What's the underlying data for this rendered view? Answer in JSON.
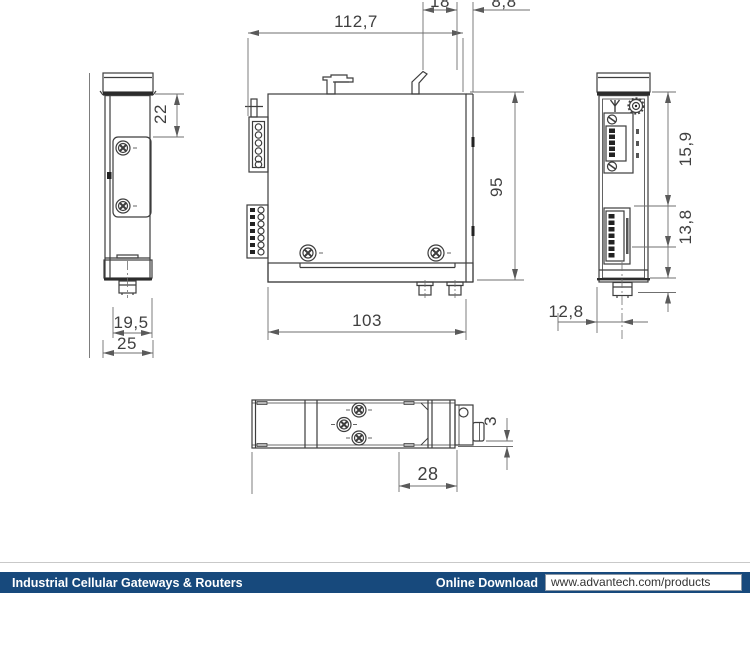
{
  "drawing": {
    "dims": {
      "top_overall_width": "112,7",
      "top_small_left": "18",
      "top_small_right": "8,8",
      "left_top_offset": "22",
      "left_inner_width": "19,5",
      "left_outer_width": "25",
      "front_height": "95",
      "front_width": "103",
      "right_block_top": "15,9",
      "right_block_bottom": "13,8",
      "right_foot_offset": "12,8",
      "bottom_section_width": "28",
      "bottom_protrusion_height": "3"
    }
  },
  "footer": {
    "category": "Industrial Cellular Gateways & Routers",
    "download_label": "Online Download",
    "url": "www.advantech.com/products",
    "bar_color": "#17497c"
  }
}
